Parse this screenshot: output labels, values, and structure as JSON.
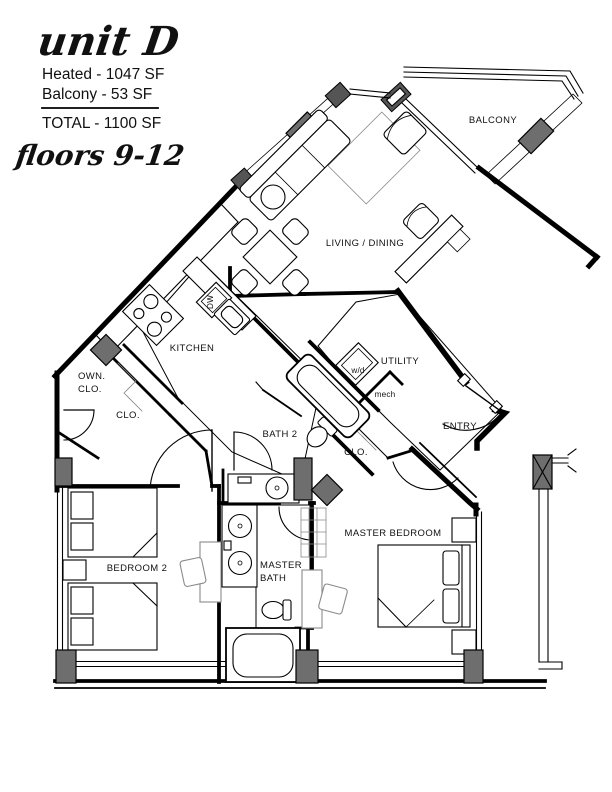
{
  "header": {
    "unit_title": "unit D",
    "heated": "Heated - 1047 SF",
    "balcony": "Balcony - 53 SF",
    "total": "TOTAL - 1100 SF",
    "floors": "floors 9-12"
  },
  "labels": {
    "balcony": "BALCONY",
    "living": "LIVING / DINING",
    "kitchen": "KITCHEN",
    "dw": "DW",
    "utility": "UTILITY",
    "wd": "w/d",
    "mech": "mech",
    "entry": "ENTRY",
    "bath2": "BATH 2",
    "clo_master": "CLO.",
    "own_clo_line1": "OWN.",
    "own_clo_line2": "CLO.",
    "clo_hall": "CLO.",
    "bedroom2": "BEDROOM 2",
    "master_bath_line1": "MASTER",
    "master_bath_line2": "BATH",
    "master_bedroom": "MASTER BEDROOM"
  },
  "colors": {
    "wall": "#000000",
    "column": "#6e6e6e",
    "tile": "#999999"
  }
}
